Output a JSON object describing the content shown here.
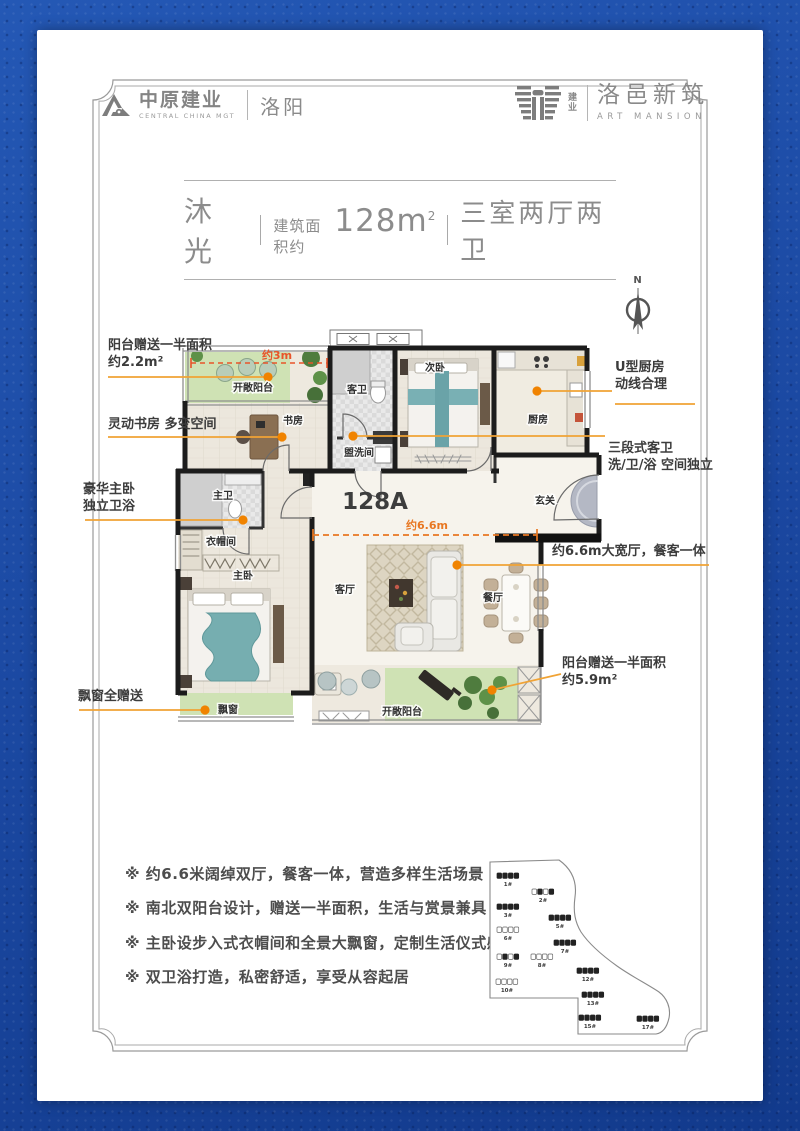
{
  "header": {
    "brand_left": {
      "name": "中原建业",
      "subtitle": "CENTRAL CHINA MGT",
      "city": "洛阳"
    },
    "brand_right": {
      "prefix": "建业",
      "name": "洛邑新筑",
      "subtitle": "ART MANSION"
    }
  },
  "title": {
    "unit_name": "沐光",
    "area_prefix": "建筑面积约",
    "area_num": "128m",
    "area_sup": "2",
    "rooms": "三室两厅两卫"
  },
  "compass": {
    "label": "N"
  },
  "plan": {
    "unit_code": "128A",
    "measure_top": "约3m",
    "measure_mid": "约6.6m",
    "rooms": [
      {
        "label": "开敞阳台",
        "x": 178,
        "y": 68
      },
      {
        "label": "书房",
        "x": 218,
        "y": 101
      },
      {
        "label": "客卫",
        "x": 282,
        "y": 70
      },
      {
        "label": "盥洗间",
        "x": 284,
        "y": 133
      },
      {
        "label": "次卧",
        "x": 360,
        "y": 48
      },
      {
        "label": "厨房",
        "x": 463,
        "y": 100
      },
      {
        "label": "主卫",
        "x": 148,
        "y": 176
      },
      {
        "label": "玄关",
        "x": 470,
        "y": 181
      },
      {
        "label": "衣帽间",
        "x": 146,
        "y": 222
      },
      {
        "label": "主卧",
        "x": 168,
        "y": 256
      },
      {
        "label": "客厅",
        "x": 270,
        "y": 270
      },
      {
        "label": "餐厅",
        "x": 418,
        "y": 278
      },
      {
        "label": "飘窗",
        "x": 153,
        "y": 390
      },
      {
        "label": "开敞阳台",
        "x": 327,
        "y": 392
      }
    ]
  },
  "annotations": {
    "left": [
      {
        "line1": "阳台赠送一半面积",
        "line2": "约2.2m²"
      },
      {
        "line1": "灵动书房 多变空间",
        "line2": ""
      },
      {
        "line1": "豪华主卧",
        "line2": "独立卫浴"
      },
      {
        "line1": "飘窗全赠送",
        "line2": ""
      }
    ],
    "right": [
      {
        "line1": "U型厨房",
        "line2": "动线合理"
      },
      {
        "line1": "三段式客卫",
        "line2": "洗/卫/浴 空间独立"
      },
      {
        "line1": "约6.6m大宽厅，餐客一体",
        "line2": ""
      },
      {
        "line1": "阳台赠送一半面积",
        "line2": "约5.9m²"
      }
    ]
  },
  "features": {
    "bullet": "※",
    "items": [
      "约6.6米阔绰双厅，餐客一体，营造多样生活场景",
      "南北双阳台设计，赠送一半面积，生活与赏景兼具",
      "主卧设步入式衣帽间和全景大飘窗，定制生活仪式感",
      "双卫浴打造，私密舒适，享受从容起居"
    ]
  },
  "siteplan": {
    "buildings": [
      {
        "label": "1#",
        "x": 33,
        "y": 26,
        "type": "dark"
      },
      {
        "label": "2#",
        "x": 68,
        "y": 42,
        "type": "mixed"
      },
      {
        "label": "3#",
        "x": 33,
        "y": 57,
        "type": "dark"
      },
      {
        "label": "5#",
        "x": 85,
        "y": 68,
        "type": "dark"
      },
      {
        "label": "6#",
        "x": 33,
        "y": 80,
        "type": "light"
      },
      {
        "label": "7#",
        "x": 90,
        "y": 93,
        "type": "dark"
      },
      {
        "label": "8#",
        "x": 67,
        "y": 107,
        "type": "light"
      },
      {
        "label": "9#",
        "x": 33,
        "y": 107,
        "type": "mixed"
      },
      {
        "label": "10#",
        "x": 32,
        "y": 132,
        "type": "light"
      },
      {
        "label": "12#",
        "x": 113,
        "y": 121,
        "type": "dark"
      },
      {
        "label": "13#",
        "x": 118,
        "y": 145,
        "type": "dark"
      },
      {
        "label": "15#",
        "x": 115,
        "y": 168,
        "type": "dark"
      },
      {
        "label": "17#",
        "x": 173,
        "y": 169,
        "type": "dark"
      }
    ]
  },
  "colors": {
    "accent_orange": "#f08300",
    "leader": "#f0a335",
    "measure_red": "#e8542a",
    "measure_orange": "#e87722",
    "balcony_green": "#cfe2b4",
    "blue_bg": "#1d4ea6"
  }
}
